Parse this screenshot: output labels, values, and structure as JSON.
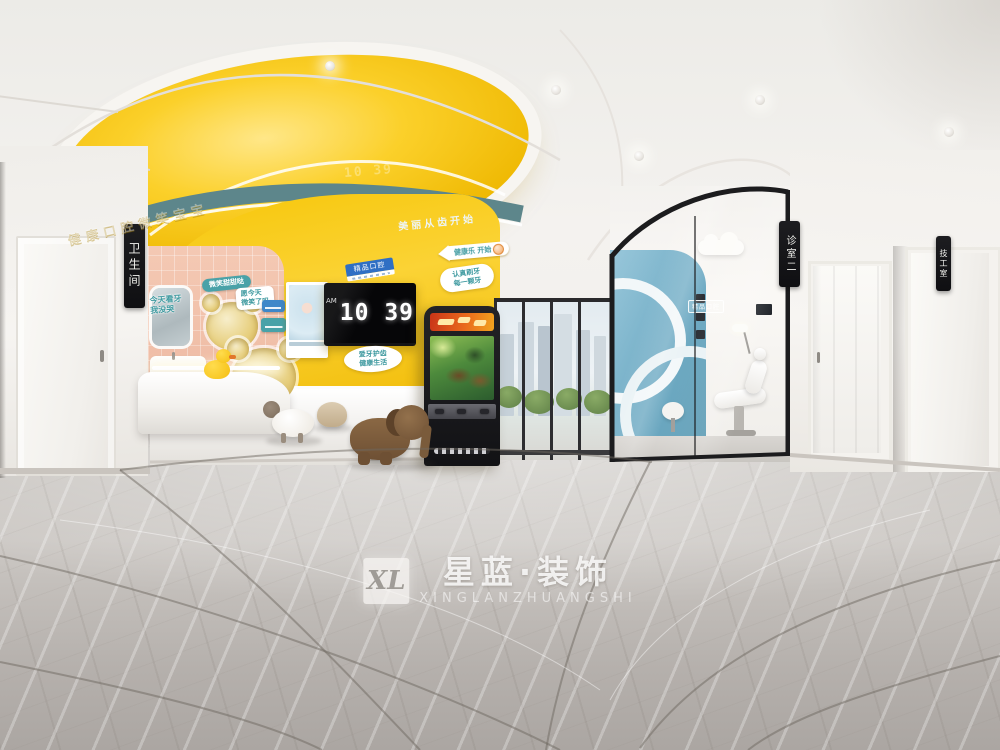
{
  "colors": {
    "accent_yellow": "#f5c30e",
    "band_teal": "#5d868b",
    "wall_pink": "#f2c2ac",
    "clinic_blue": "#79aec6",
    "floor_gray": "#bcb8b4"
  },
  "watermark": {
    "logo": "XL",
    "brand": "星蓝·装饰",
    "latin": "XINGLANZHUANGSHI"
  },
  "signs": {
    "restroom": "卫生间",
    "clinic_room_2": "诊室二",
    "lab_room": "技工室",
    "boutique_chip": "精品口腔",
    "glass_room": "精品口腔"
  },
  "slogans": {
    "band": "美丽从齿开始",
    "emboss": "健康口腔微笑宝宝",
    "arrow": "健康乐 开始",
    "badge_top": "认真刷牙",
    "badge_bottom": "每一颗牙",
    "tv_badge_top": "爱牙护齿",
    "tv_badge_bottom": "健康生活"
  },
  "tv": {
    "meridiem": "AM",
    "time": "10 39"
  },
  "decals": {
    "a1": "今天看牙",
    "a2": "我没哭",
    "b": "微笑甜甜哒",
    "c1": "愿今天",
    "c2": "微笑了吗"
  }
}
